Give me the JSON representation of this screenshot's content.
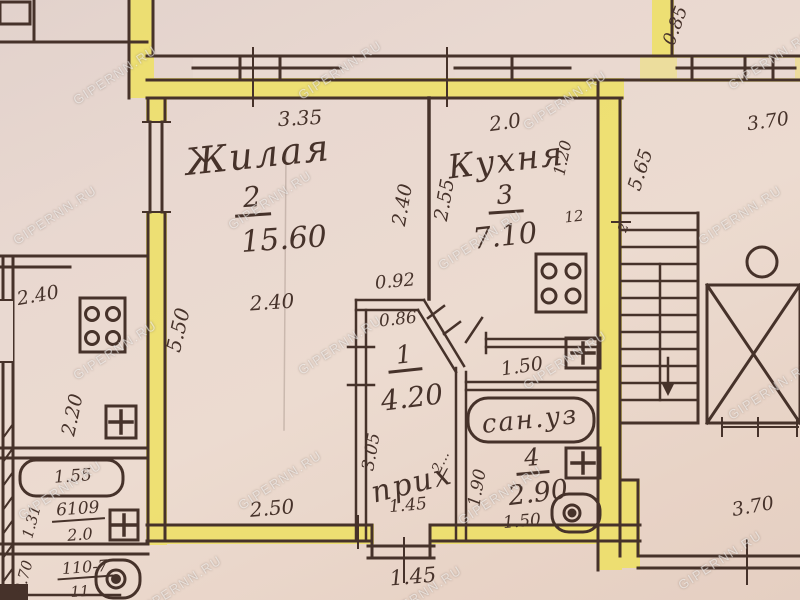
{
  "watermark": "GIPERNN.RU",
  "colors": {
    "paper": "#e9d8d0",
    "ink": "#46322a",
    "wall_highlight": "#eee15e"
  },
  "rooms": {
    "living": {
      "name": "Жилая",
      "number": "2",
      "area": "15.60"
    },
    "kitchen": {
      "name": "Кухня",
      "number": "3",
      "area": "7.10"
    },
    "hallway": {
      "name": "прих",
      "number": "1",
      "area": "4.20"
    },
    "bathroom": {
      "name": "сан.уз",
      "number": "4",
      "area": "2.90"
    }
  },
  "dims": {
    "living_top": "3.35",
    "living_side": "2.40",
    "living_left": "5.50",
    "living_mid": "2.40",
    "living_bottom": "2.50",
    "kitchen_top": "2.0",
    "kitchen_left": "2.55",
    "kitchen_right": "1.20",
    "kitchen_note": "12",
    "niche": "0.92",
    "hall_top": "0.86",
    "hall_left": "3.05",
    "hall_width": "1.45",
    "hall_diag": "2...",
    "corridor": "1.50",
    "bath_left": "1.90",
    "bath_bottom": "1.50",
    "entry": "1.45",
    "stair_height": "5.65",
    "stair_top": "3.70",
    "stair_jog": "0.85",
    "stair_note": "2",
    "stair_bottom": "3.70",
    "nb_kitchen_top": "2.40",
    "nb_kitchen_side": "2.20",
    "nb_bath": "1.55",
    "nb_code1": "6109",
    "nb_code1_den": "2.0",
    "nb_left1": "1.31",
    "nb_code2": "110-7",
    "nb_code2_den": "11",
    "nb_left2": "0.70"
  }
}
